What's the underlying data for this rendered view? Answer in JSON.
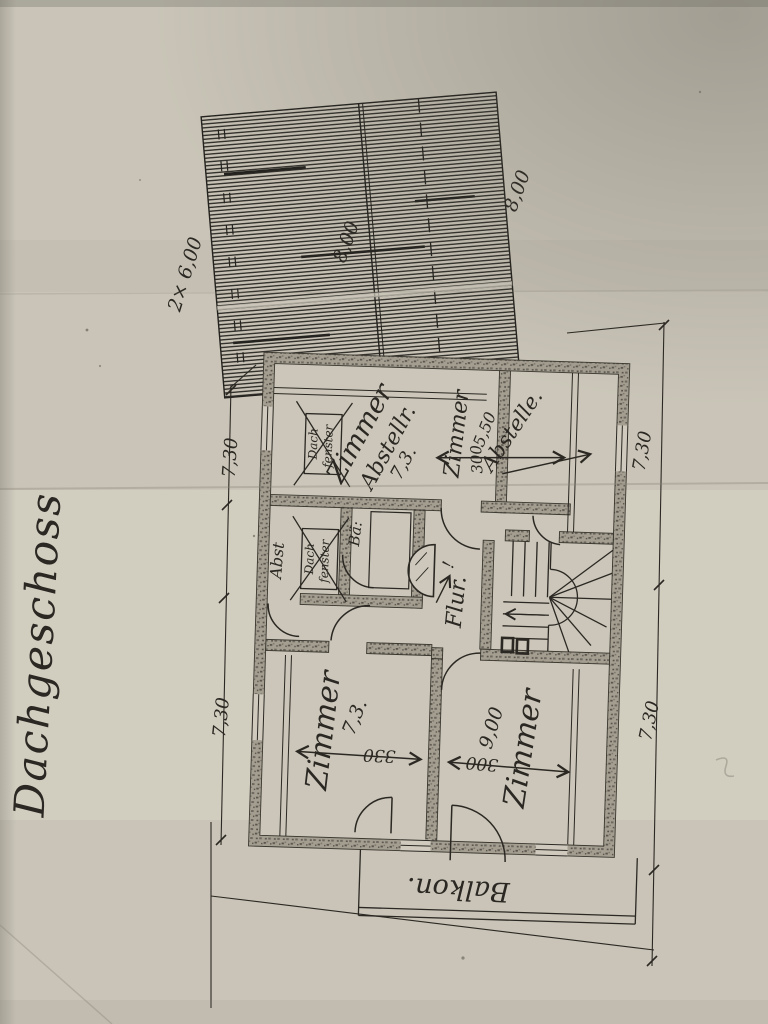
{
  "title": "Dachgeschoss",
  "roof": {
    "dim_left": "2× 6,00",
    "dim_mid": "8,00",
    "dim_right": "8,00"
  },
  "rooms": {
    "nw": {
      "name": "Zimmer",
      "sub": "Abstellr.",
      "area": "7,3."
    },
    "dachfenster": {
      "line1": "Dach",
      "line2": "fenster"
    },
    "abst": {
      "name": "Abst"
    },
    "bad": {
      "name": "Bä:"
    },
    "ne": {
      "name": "Zimmer",
      "width": "5,50",
      "depth": "300"
    },
    "ne_strip": {
      "name": "Abstelle."
    },
    "flur": {
      "name": "Flur.",
      "mark": "!"
    },
    "sw": {
      "name": "Zimmer",
      "area": "7,3.",
      "width": "330"
    },
    "se": {
      "name": "Zimmer",
      "area": "9,00",
      "width": "300"
    },
    "balkon": {
      "name": "Balkon."
    }
  },
  "dims": {
    "left_top": "7,30",
    "left_bottom": "7,30",
    "right_top": "7,30",
    "right_bottom": "7,30"
  },
  "colors": {
    "paper": "#c9c4b7",
    "ink": "#2b2823",
    "wall_fill": "#a29c8f"
  }
}
